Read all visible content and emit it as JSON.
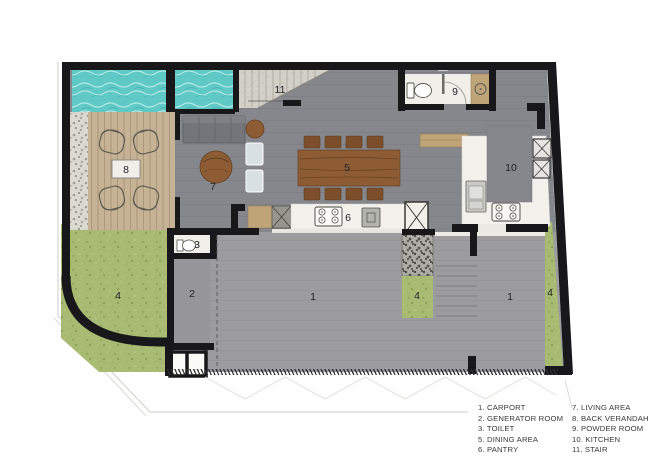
{
  "plan": {
    "labels": [
      {
        "room": "stair",
        "text": "11",
        "x": 280,
        "y": 90
      },
      {
        "room": "powder-room",
        "text": "9",
        "x": 455,
        "y": 92
      },
      {
        "room": "back-verandah",
        "text": "8",
        "x": 126,
        "y": 170
      },
      {
        "room": "living-area",
        "text": "7",
        "x": 213,
        "y": 187
      },
      {
        "room": "dining-area",
        "text": "5",
        "x": 347,
        "y": 168
      },
      {
        "room": "kitchen",
        "text": "10",
        "x": 511,
        "y": 168
      },
      {
        "room": "pantry",
        "text": "6",
        "x": 348,
        "y": 218
      },
      {
        "room": "toilet",
        "text": "3",
        "x": 197,
        "y": 245
      },
      {
        "room": "generator-room",
        "text": "2",
        "x": 192,
        "y": 294
      },
      {
        "room": "garden-left",
        "text": "4",
        "x": 118,
        "y": 296
      },
      {
        "room": "carport-main",
        "text": "1",
        "x": 313,
        "y": 297
      },
      {
        "room": "planter-mid",
        "text": "4",
        "x": 417,
        "y": 296
      },
      {
        "room": "carport-right",
        "text": "1",
        "x": 510,
        "y": 297
      },
      {
        "room": "planter-right",
        "text": "4",
        "x": 550,
        "y": 293
      }
    ]
  },
  "legend": {
    "columns": [
      {
        "items": [
          "1. CARPORT",
          "2. GENERATOR ROOM",
          "3. TOILET",
          "5. DINING AREA",
          "6. PANTRY"
        ]
      },
      {
        "items": [
          "7. LIVING AREA",
          "8. BACK VERANDAH",
          "9. POWDER ROOM",
          "10. KITCHEN",
          "11. STAIR"
        ]
      }
    ]
  },
  "colors": {
    "wall": "#18181a",
    "floor": "#86878c",
    "carport": "#9c9c9f",
    "pool": "#5fc9c6",
    "deck": "#c6b294",
    "grass": "#a9ba72",
    "counter": "#f2f1ec",
    "wood": "#8d5c35",
    "woodlight": "#bfa478",
    "concrete": "#d3d0c8",
    "sofa": "#73757b",
    "cushion": "#d9e0e4",
    "text": "#222326",
    "legendtext": "#3a3a3c",
    "line": "#cfcfcb"
  }
}
